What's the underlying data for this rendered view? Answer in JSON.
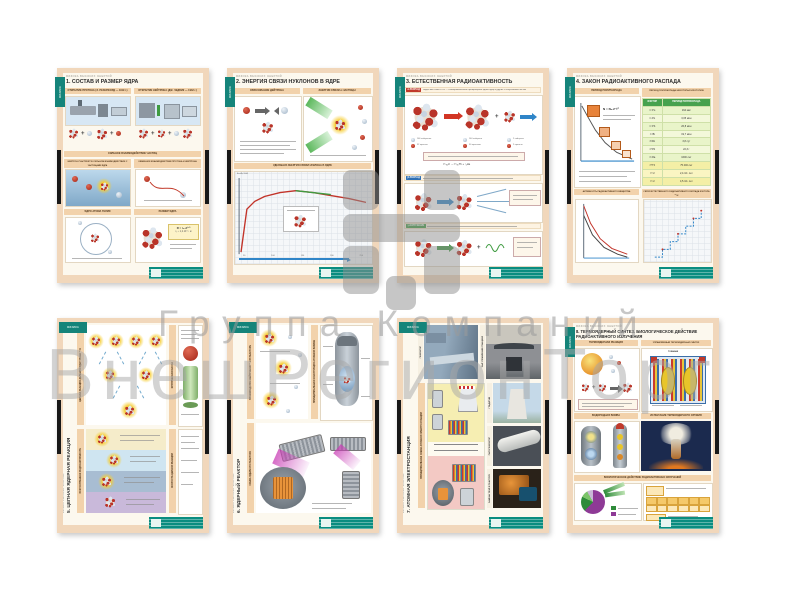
{
  "watermark": {
    "line1": "Группа Компаний",
    "line2": "ВнешРегионТорг"
  },
  "common": {
    "series": "ФИЗИКА ВЫСОКИХ ЭНЕРГИЙ",
    "tab": "ФИЗИКА",
    "accent_teal": "#15847a",
    "frame_peach": "#f1d7bb",
    "publisher_teal": "#0a8d80"
  },
  "posters": {
    "p1": {
      "title": "1. СОСТАВ И РАЗМЕР ЯДРА",
      "s_proton": "ОТКРЫТИЕ ПРОТОНА (Э. РЕЗЕРФОРД — 1919 г.)",
      "s_neutron": "ОТКРЫТИЕ НЕЙТРОНА (ДЖ. ЧЕДВИК — 1932 г.)",
      "s_strong": "СИЛЬНОЕ ВЗАИМОДЕЙСТВИЕ ЧАСТИЦ",
      "s_strong_a": "НЕЙТРОН УЧАСТВУЕТ В СИЛЬНОМ ВЗАИМОДЕЙСТВИИ С ЧАСТИЦАМИ ЯДРА",
      "s_strong_b": "ОБМЕННОЕ ВЗАИМОДЕЙСТВИЕ ПРОТОНА И НЕЙТРОНА",
      "s_helium": "ЯДРО АТОМА ГЕЛИЯ",
      "s_size": "РАЗМЕР ЯДРА",
      "f_radius": "R = r₀·A¹ᐟ³",
      "f_r0": "r₀ ≈ 1,2·10⁻¹⁵ м"
    },
    "p2": {
      "title": "2. ЭНЕРГИЯ СВЯЗИ НУКЛОНОВ В ЯДРЕ",
      "s_deuteron": "ОБРАЗОВАНИЕ ДЕЙТРОНА",
      "s_alpha": "ЭНЕРГИЯ СВЯЗИ α-ЧАСТИЦЫ",
      "s_graph": "УДЕЛЬНАЯ ЭНЕРГИЯ СВЯЗИ НУКЛОНА В ЯДРЕ",
      "graph": {
        "ylabel": "Eсв/A, МэВ",
        "xticks": [
          "50",
          "100",
          "150",
          "200",
          "250"
        ],
        "curve": [
          [
            6,
            78
          ],
          [
            12,
            34
          ],
          [
            20,
            26
          ],
          [
            30,
            21
          ],
          [
            46,
            17
          ],
          [
            62,
            15
          ],
          [
            80,
            17
          ],
          [
            98,
            20
          ],
          [
            116,
            23
          ],
          [
            134,
            27
          ]
        ],
        "green": [
          [
            62,
            15
          ],
          [
            98,
            19
          ]
        ]
      }
    },
    "p3": {
      "title": "3. ЕСТЕСТВЕННАЯ РАДИОАКТИВНОСТЬ",
      "chip_alpha": "α-РАСПАД",
      "chip_beta": "β-РАСПАД",
      "chip_gamma": "γ-ИЗЛУЧЕНИЕ",
      "intro": "РАДИОАКТИВНОСТЬ — самопроизвольное превращение одних ядер в другие с испусканием частиц",
      "eq_alpha": "²³⁸₉₂U → ²³⁴₉₀Th + ⁴₂He",
      "leg1": "146 нейтронов",
      "leg2": "92 протона",
      "leg3": "144 нейтрона",
      "leg4": "90 протонов",
      "leg5": "2 нейтрона",
      "leg6": "2 протона"
    },
    "p4": {
      "title": "4. ЗАКОН РАДИОАКТИВНОГО РАСПАДА",
      "s_half": "ПЕРИОД ПОЛУРАСПАДА",
      "s_table": "ПЕРИОД ПОЛУРАСПАДА НЕКОТОРЫХ ИЗОТОПОВ",
      "formula": "N = N₀·2⁻ᵗ⁄ᵀ",
      "s_activity": "АКТИВНОСТЬ РАДИОАКТИВНОГО ВЕЩЕСТВА",
      "s_series": "СЕРИЯ ЕСТЕСТВЕННОГО РАДИОАКТИВНОГО РАСПАДА ИЗОТОПА ²³⁸U",
      "table": {
        "h1": "ИЗОТОП",
        "h2": "ПЕРИОД ПОЛУРАСПАДА",
        "rows": [
          [
            "²¹⁴Po",
            "164 мкс"
          ],
          [
            "²¹⁸Po",
            "3,05 мин"
          ],
          [
            "²¹⁴Pb",
            "26,8 мин"
          ],
          [
            "²¹⁴Bi",
            "19,7 мин"
          ],
          [
            "²²²Rn",
            "3,8 сут"
          ],
          [
            "²¹⁰Pb",
            "22,3 г"
          ],
          [
            "²²⁶Ra",
            "1600 лет"
          ],
          [
            "²³⁰Th",
            "75 400 лет"
          ],
          [
            "²³⁴U",
            "2,4·10⁵ лет"
          ],
          [
            "²³⁸U",
            "4,5·10⁹ лет"
          ]
        ]
      },
      "charts": {
        "decay": [
          [
            4,
            5
          ],
          [
            10,
            16
          ],
          [
            18,
            30
          ],
          [
            28,
            43
          ],
          [
            40,
            53
          ],
          [
            56,
            60
          ]
        ],
        "act_red": [
          [
            3,
            4
          ],
          [
            10,
            22
          ],
          [
            20,
            38
          ],
          [
            32,
            48
          ],
          [
            48,
            54
          ]
        ],
        "act_black": [
          [
            3,
            14
          ],
          [
            12,
            34
          ],
          [
            24,
            47
          ],
          [
            38,
            54
          ],
          [
            48,
            57
          ]
        ],
        "stairs": [
          [
            5,
            58
          ],
          [
            13,
            58
          ],
          [
            13,
            50
          ],
          [
            21,
            50
          ],
          [
            21,
            42
          ],
          [
            29,
            42
          ],
          [
            29,
            34
          ],
          [
            37,
            34
          ],
          [
            37,
            26
          ],
          [
            45,
            26
          ],
          [
            45,
            18
          ],
          [
            53,
            18
          ],
          [
            53,
            10
          ]
        ]
      }
    },
    "p5": {
      "title": "5. ЦЕПНАЯ ЯДЕРНАЯ РЕАКЦИЯ",
      "s_chain": "ЦЕПНАЯ РЕАКЦИЯ ДЕЛЕНИЯ ЯДЕР УРАНА ²³⁵U",
      "s_critical": "КРИТИЧЕСКАЯ МАССА",
      "s_artificial": "ИСКУССТВЕННАЯ РАДИОАКТИВНОСТЬ",
      "s_speed": "СКОРОСТЬ ЦЕПНОЙ РЕАКЦИИ"
    },
    "p6": {
      "title": "6. ЯДЕРНЫЙ РЕАКТОР",
      "s_neutrons": "ПРОИЗВОДСТВО НЕЙТРОНОВ ²³⁵U В РЕАКТОРЕ",
      "s_bomb": "ПРИНЦИПИАЛЬНАЯ КОНСТРУКЦИЯ АТОМНОЙ БОМБЫ",
      "s_schema": "СХЕМА ЯДЕРНОГО РЕАКТОРА"
    },
    "p7": {
      "title": "7. АТОМНАЯ ЭЛЕКТРОСТАНЦИЯ",
      "s_schema": "ПРИНЦИПИАЛЬНАЯ СХЕМА АТОМНОЙ ЭЛЕКТРОСТАНЦИИ",
      "ph1": "ГЕНЕРАТОР",
      "ph2": "ЗАЛ УПРАВЛЕНИЯ СТАНЦИЕЙ",
      "ph3": "ГРАДИРНЯ",
      "ph4": "ПАРОГЕНЕРАТОР",
      "ph5": "ЗАМЕНА ТВЭЛ В РЕАКТОРЕ"
    },
    "p8": {
      "title1": "8. ТЕРМОЯДЕРНЫЙ СИНТЕЗ. БИОЛОГИЧЕСКОЕ ДЕЙСТВИЕ",
      "title2": "РАДИОАКТИВНОГО ИЗЛУЧЕНИЯ",
      "s_reaction": "ТЕРМОЯДЕРНАЯ РЕАКЦИЯ",
      "s_fusion": "УПРАВЛЯЕМЫЙ ТЕРМОЯДЕРНЫЙ СИНТЕЗ",
      "tokamak": "ТОКАМАК",
      "s_hbomb": "ВОДОРОДНАЯ БОМБА",
      "s_test": "ИСПЫТАНИЕ ТЕРМОЯДЕРНОГО ОРУЖИЯ",
      "s_bio": "БИОЛОГИЧЕСКОЕ ДЕЙСТВИЕ РАДИОАКТИВНЫХ ИЗЛУЧЕНИЙ"
    }
  }
}
